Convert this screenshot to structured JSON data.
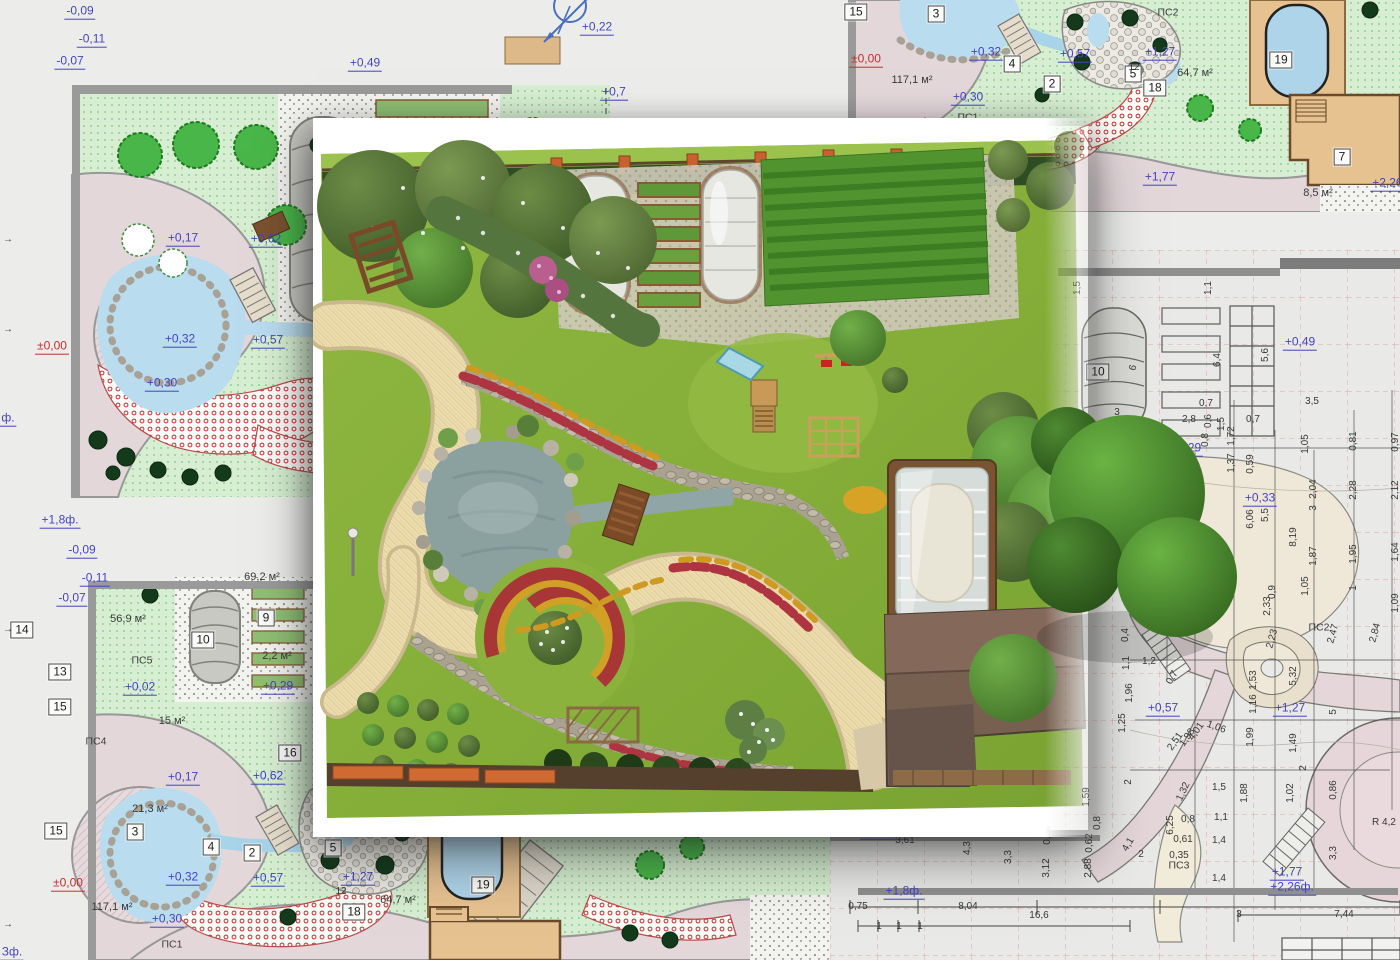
{
  "title": "Landscape design plan with 3D garden visualization",
  "colors": {
    "page_bg": "#ecedeb",
    "blueprint_lawn": "#d8eed3",
    "blueprint_path": "#e3d7da",
    "water": "#b9dcee",
    "annotation_blue": "#4443c6",
    "annotation_red": "#c32f2f",
    "tech_grid_red": "#dca9a9",
    "render_lawn": "#86ae39",
    "render_path": "#ecdcae",
    "roof_brown": "#77604f",
    "fence_orange": "#c9602f"
  },
  "compass": {
    "icon": "north-arrow"
  },
  "page_marks": [
    {
      "t": "→",
      "x": 8,
      "y": 240,
      "k": "dim"
    },
    {
      "t": "→",
      "x": 8,
      "y": 330,
      "k": "dim"
    },
    {
      "t": "→",
      "x": 8,
      "y": 630,
      "k": "dim"
    },
    {
      "t": "→",
      "x": 8,
      "y": 925,
      "k": "dim"
    }
  ],
  "top_left_plan": {
    "labels": [
      {
        "t": "-0,09",
        "x": 80,
        "y": 12,
        "k": "el"
      },
      {
        "t": "-0,11",
        "x": 92,
        "y": 40,
        "k": "el"
      },
      {
        "t": "-0,07",
        "x": 70,
        "y": 62,
        "k": "el"
      },
      {
        "t": "+0,49",
        "x": 365,
        "y": 64,
        "k": "el"
      },
      {
        "t": "+0,22",
        "x": 597,
        "y": 28,
        "k": "el"
      },
      {
        "t": "+0,7",
        "x": 614,
        "y": 93,
        "k": "el"
      },
      {
        "t": "+0,17",
        "x": 183,
        "y": 239,
        "k": "el"
      },
      {
        "t": "+0,62",
        "x": 266,
        "y": 240,
        "k": "el"
      },
      {
        "t": "+0,32",
        "x": 180,
        "y": 340,
        "k": "el"
      },
      {
        "t": "+0,57",
        "x": 268,
        "y": 341,
        "k": "el"
      },
      {
        "t": "±0,00",
        "x": 52,
        "y": 347,
        "k": "red"
      },
      {
        "t": "+0,30",
        "x": 162,
        "y": 384,
        "k": "el"
      },
      {
        "t": "+1,8ф.",
        "x": 60,
        "y": 521,
        "k": "el"
      },
      {
        "t": "ф.",
        "x": 8,
        "y": 419,
        "k": "el"
      }
    ]
  },
  "bottom_left_plan": {
    "labels": [
      {
        "t": "-0,09",
        "x": 82,
        "y": 551,
        "k": "el"
      },
      {
        "t": "-0,11",
        "x": 95,
        "y": 579,
        "k": "el"
      },
      {
        "t": "-0,07",
        "x": 72,
        "y": 599,
        "k": "el"
      },
      {
        "t": "56,9 м²",
        "x": 128,
        "y": 620,
        "k": "area"
      },
      {
        "t": "69,2 м²",
        "x": 262,
        "y": 578,
        "k": "area"
      },
      {
        "t": "9",
        "x": 266,
        "y": 618,
        "k": "box"
      },
      {
        "t": "10",
        "x": 203,
        "y": 640,
        "k": "box"
      },
      {
        "t": "2,2 м²",
        "x": 277,
        "y": 657,
        "k": "area"
      },
      {
        "t": "+0,29",
        "x": 278,
        "y": 687,
        "k": "el"
      },
      {
        "t": "ПС5",
        "x": 142,
        "y": 661,
        "k": "code"
      },
      {
        "t": "+0,02",
        "x": 140,
        "y": 688,
        "k": "el"
      },
      {
        "t": "14",
        "x": 22,
        "y": 630,
        "k": "box"
      },
      {
        "t": "13",
        "x": 60,
        "y": 672,
        "k": "box"
      },
      {
        "t": "15",
        "x": 60,
        "y": 707,
        "k": "box"
      },
      {
        "t": "ПС4",
        "x": 96,
        "y": 742,
        "k": "code"
      },
      {
        "t": "15 м²",
        "x": 172,
        "y": 722,
        "k": "area"
      },
      {
        "t": "16",
        "x": 290,
        "y": 753,
        "k": "box"
      },
      {
        "t": "+0,17",
        "x": 183,
        "y": 778,
        "k": "el"
      },
      {
        "t": "+0,62",
        "x": 268,
        "y": 777,
        "k": "el"
      },
      {
        "t": "21,3 м²",
        "x": 150,
        "y": 810,
        "k": "area"
      },
      {
        "t": "3",
        "x": 135,
        "y": 832,
        "k": "box"
      },
      {
        "t": "15",
        "x": 56,
        "y": 831,
        "k": "box"
      },
      {
        "t": "4",
        "x": 211,
        "y": 847,
        "k": "box"
      },
      {
        "t": "2",
        "x": 252,
        "y": 853,
        "k": "box"
      },
      {
        "t": "5",
        "x": 333,
        "y": 848,
        "k": "box"
      },
      {
        "t": "±0,00",
        "x": 68,
        "y": 884,
        "k": "red"
      },
      {
        "t": "+0,32",
        "x": 183,
        "y": 878,
        "k": "el"
      },
      {
        "t": "+0,57",
        "x": 268,
        "y": 879,
        "k": "el"
      },
      {
        "t": "+1,27",
        "x": 358,
        "y": 878,
        "k": "el"
      },
      {
        "t": "12",
        "x": 341,
        "y": 892,
        "k": "dim"
      },
      {
        "t": "18",
        "x": 354,
        "y": 912,
        "k": "box"
      },
      {
        "t": "64,7 м²",
        "x": 398,
        "y": 901,
        "k": "area"
      },
      {
        "t": "117,1 м²",
        "x": 112,
        "y": 908,
        "k": "area"
      },
      {
        "t": "+0,30",
        "x": 167,
        "y": 920,
        "k": "el"
      },
      {
        "t": "ПС1",
        "x": 172,
        "y": 945,
        "k": "code"
      },
      {
        "t": "19",
        "x": 483,
        "y": 885,
        "k": "box"
      },
      {
        "t": "Зф.",
        "x": 12,
        "y": 953,
        "k": "el"
      }
    ]
  },
  "top_right_plan": {
    "labels": [
      {
        "t": "15",
        "x": 856,
        "y": 12,
        "k": "box"
      },
      {
        "t": "3",
        "x": 936,
        "y": 14,
        "k": "box"
      },
      {
        "t": "4",
        "x": 1012,
        "y": 64,
        "k": "box"
      },
      {
        "t": "2",
        "x": 1052,
        "y": 84,
        "k": "box"
      },
      {
        "t": "5",
        "x": 1133,
        "y": 74,
        "k": "box"
      },
      {
        "t": "ПС2",
        "x": 1168,
        "y": 13,
        "k": "code"
      },
      {
        "t": "±0,00",
        "x": 866,
        "y": 60,
        "k": "red"
      },
      {
        "t": "+0,32",
        "x": 986,
        "y": 53,
        "k": "el"
      },
      {
        "t": "+0,57",
        "x": 1075,
        "y": 55,
        "k": "el"
      },
      {
        "t": "117,1 м²",
        "x": 912,
        "y": 81,
        "k": "area"
      },
      {
        "t": "+0,30",
        "x": 968,
        "y": 98,
        "k": "el"
      },
      {
        "t": "ПС1",
        "x": 968,
        "y": 118,
        "k": "code"
      },
      {
        "t": "+1,27",
        "x": 1160,
        "y": 53,
        "k": "el"
      },
      {
        "t": "12",
        "x": 1134,
        "y": 68,
        "k": "dim"
      },
      {
        "t": "18",
        "x": 1155,
        "y": 88,
        "k": "box"
      },
      {
        "t": "64,7 м²",
        "x": 1195,
        "y": 74,
        "k": "area"
      },
      {
        "t": "19",
        "x": 1281,
        "y": 60,
        "k": "box"
      },
      {
        "t": "7",
        "x": 1342,
        "y": 157,
        "k": "box"
      },
      {
        "t": "+1,77",
        "x": 1160,
        "y": 178,
        "k": "el"
      },
      {
        "t": "+2,26ф.",
        "x": 1394,
        "y": 184,
        "k": "el"
      },
      {
        "t": "8,5 м²",
        "x": 1318,
        "y": 194,
        "k": "area"
      }
    ]
  },
  "tech_drawing": {
    "labels": [
      {
        "t": "1,5",
        "x": 1078,
        "y": 288,
        "r": -90
      },
      {
        "t": "1,1",
        "x": 1209,
        "y": 288,
        "r": -90
      },
      {
        "t": "10",
        "x": 1098,
        "y": 372,
        "k": "box"
      },
      {
        "t": "6",
        "x": 1134,
        "y": 368,
        "r": -75
      },
      {
        "t": "6,4",
        "x": 1218,
        "y": 360,
        "r": -90
      },
      {
        "t": "5,6",
        "x": 1266,
        "y": 355,
        "r": -90
      },
      {
        "t": "+0,49",
        "x": 1300,
        "y": 343,
        "k": "el"
      },
      {
        "t": "3,5",
        "x": 1312,
        "y": 402
      },
      {
        "t": "0,7",
        "x": 1206,
        "y": 404
      },
      {
        "t": "2,8",
        "x": 1189,
        "y": 420
      },
      {
        "t": "0,6",
        "x": 1209,
        "y": 421,
        "r": -90
      },
      {
        "t": "1,5",
        "x": 1222,
        "y": 424,
        "r": -90
      },
      {
        "t": "0,7",
        "x": 1253,
        "y": 420
      },
      {
        "t": "1,72",
        "x": 1232,
        "y": 436,
        "r": -90
      },
      {
        "t": "0,8",
        "x": 1206,
        "y": 440,
        "r": -90
      },
      {
        "t": "3",
        "x": 1117,
        "y": 413
      },
      {
        "t": "0,9",
        "x": 1133,
        "y": 428,
        "r": -60
      },
      {
        "t": "+0,29",
        "x": 1186,
        "y": 449,
        "k": "el"
      },
      {
        "t": "1,37",
        "x": 1232,
        "y": 463,
        "r": -90
      },
      {
        "t": "0,59",
        "x": 1251,
        "y": 464,
        "r": -90
      },
      {
        "t": "1,05",
        "x": 1306,
        "y": 444,
        "r": -90
      },
      {
        "t": "0,81",
        "x": 1354,
        "y": 441,
        "r": -90
      },
      {
        "t": "0,97",
        "x": 1396,
        "y": 442,
        "r": -90
      },
      {
        "t": "2,04",
        "x": 1314,
        "y": 489,
        "r": -90
      },
      {
        "t": "2,28",
        "x": 1354,
        "y": 490,
        "r": -90
      },
      {
        "t": "2,12",
        "x": 1396,
        "y": 490,
        "r": -90
      },
      {
        "t": "+0,33",
        "x": 1260,
        "y": 499,
        "k": "el"
      },
      {
        "t": "6,06",
        "x": 1251,
        "y": 519,
        "r": -90
      },
      {
        "t": "5,5",
        "x": 1266,
        "y": 515,
        "r": -90
      },
      {
        "t": "3",
        "x": 1314,
        "y": 508,
        "r": -90
      },
      {
        "t": "8,19",
        "x": 1294,
        "y": 537,
        "r": -90
      },
      {
        "t": "1,87",
        "x": 1314,
        "y": 556,
        "r": -90
      },
      {
        "t": "1,95",
        "x": 1354,
        "y": 554,
        "r": -90
      },
      {
        "t": "1,64",
        "x": 1396,
        "y": 552,
        "r": -90
      },
      {
        "t": "1,05",
        "x": 1306,
        "y": 586,
        "r": -90
      },
      {
        "t": "0,9",
        "x": 1273,
        "y": 592,
        "r": -90
      },
      {
        "t": "2,33",
        "x": 1268,
        "y": 606,
        "r": -90
      },
      {
        "t": "1",
        "x": 1354,
        "y": 588,
        "r": -90
      },
      {
        "t": "1,09",
        "x": 1396,
        "y": 603,
        "r": -90
      },
      {
        "t": "ПС2",
        "x": 1319,
        "y": 628,
        "k": "code"
      },
      {
        "t": "2,47",
        "x": 1334,
        "y": 634,
        "r": -75
      },
      {
        "t": "2,84",
        "x": 1376,
        "y": 633,
        "r": -75
      },
      {
        "t": "2,23",
        "x": 1273,
        "y": 639,
        "r": -75
      },
      {
        "t": "0,4",
        "x": 1126,
        "y": 635,
        "r": -90
      },
      {
        "t": "1,2",
        "x": 1149,
        "y": 662
      },
      {
        "t": "1,1",
        "x": 1127,
        "y": 663,
        "r": -90
      },
      {
        "t": "1,96",
        "x": 1130,
        "y": 693,
        "r": -90
      },
      {
        "t": "0,7",
        "x": 1173,
        "y": 678,
        "r": -60
      },
      {
        "t": "1,53",
        "x": 1254,
        "y": 680,
        "r": -90
      },
      {
        "t": "1,16",
        "x": 1254,
        "y": 704,
        "r": -90
      },
      {
        "t": "5,32",
        "x": 1294,
        "y": 676,
        "r": -90
      },
      {
        "t": "+1,27",
        "x": 1290,
        "y": 709,
        "k": "el"
      },
      {
        "t": "+0,57",
        "x": 1163,
        "y": 709,
        "k": "el"
      },
      {
        "t": "1,06",
        "x": 1216,
        "y": 728,
        "r": 20
      },
      {
        "t": "4,01",
        "x": 1197,
        "y": 732,
        "r": -55
      },
      {
        "t": "2,51",
        "x": 1176,
        "y": 742,
        "r": -55
      },
      {
        "t": "1,98",
        "x": 1188,
        "y": 738,
        "r": -55
      },
      {
        "t": "1,99",
        "x": 1251,
        "y": 737,
        "r": -90
      },
      {
        "t": "1,49",
        "x": 1294,
        "y": 743,
        "r": -90
      },
      {
        "t": "5",
        "x": 1334,
        "y": 712,
        "r": -90
      },
      {
        "t": "1,25",
        "x": 1123,
        "y": 723,
        "r": -90
      },
      {
        "t": "2",
        "x": 1129,
        "y": 782,
        "r": -90
      },
      {
        "t": "1,32",
        "x": 1184,
        "y": 792,
        "r": -65
      },
      {
        "t": "1,5",
        "x": 1219,
        "y": 788
      },
      {
        "t": "1,88",
        "x": 1245,
        "y": 793,
        "r": -90
      },
      {
        "t": "1,02",
        "x": 1291,
        "y": 793,
        "r": -90
      },
      {
        "t": "0,86",
        "x": 1334,
        "y": 790,
        "r": -90
      },
      {
        "t": "2",
        "x": 1304,
        "y": 768,
        "r": -90
      },
      {
        "t": "6,25",
        "x": 1171,
        "y": 825,
        "r": -90
      },
      {
        "t": "0,8",
        "x": 1188,
        "y": 820
      },
      {
        "t": "1,1",
        "x": 1221,
        "y": 818
      },
      {
        "t": "R 4,2",
        "x": 1384,
        "y": 823
      },
      {
        "t": "0,61",
        "x": 1183,
        "y": 840
      },
      {
        "t": "1,4",
        "x": 1219,
        "y": 841
      },
      {
        "t": "0,35",
        "x": 1179,
        "y": 856
      },
      {
        "t": "ПС3",
        "x": 1179,
        "y": 866,
        "k": "code"
      },
      {
        "t": "1,4",
        "x": 1219,
        "y": 879
      },
      {
        "t": "+1,77",
        "x": 1287,
        "y": 873,
        "k": "el"
      },
      {
        "t": "+2,26ф.",
        "x": 1292,
        "y": 888,
        "k": "el"
      },
      {
        "t": "3",
        "x": 1239,
        "y": 915
      },
      {
        "t": "7,44",
        "x": 1344,
        "y": 915
      },
      {
        "t": "3,3",
        "x": 1334,
        "y": 853,
        "r": -90
      },
      {
        "t": "+0,7",
        "x": 895,
        "y": 822,
        "k": "el"
      },
      {
        "t": "+1,03ф.",
        "x": 884,
        "y": 832,
        "k": "el"
      },
      {
        "t": "0,3",
        "x": 930,
        "y": 827,
        "r": -90
      },
      {
        "t": "3,61",
        "x": 905,
        "y": 841
      },
      {
        "t": "4,3",
        "x": 968,
        "y": 848,
        "r": -90
      },
      {
        "t": "3,3",
        "x": 1009,
        "y": 857,
        "r": -90
      },
      {
        "t": "0,58",
        "x": 1048,
        "y": 835,
        "r": -90
      },
      {
        "t": "3,12",
        "x": 1047,
        "y": 868,
        "r": -90
      },
      {
        "t": "2,88",
        "x": 1089,
        "y": 868,
        "r": -90
      },
      {
        "t": "0,62",
        "x": 1090,
        "y": 843,
        "r": -90
      },
      {
        "t": "1,59",
        "x": 1087,
        "y": 797,
        "r": -90
      },
      {
        "t": "0,8",
        "x": 1098,
        "y": 823,
        "r": -90
      },
      {
        "t": "+1,8ф.",
        "x": 904,
        "y": 892,
        "k": "el"
      },
      {
        "t": "0,75",
        "x": 858,
        "y": 907
      },
      {
        "t": "8,04",
        "x": 968,
        "y": 907
      },
      {
        "t": "16,6",
        "x": 1039,
        "y": 916
      },
      {
        "t": "1",
        "x": 879,
        "y": 927
      },
      {
        "t": "1",
        "x": 899,
        "y": 927
      },
      {
        "t": "1",
        "x": 920,
        "y": 927
      },
      {
        "t": "4,1",
        "x": 1129,
        "y": 845,
        "r": -60
      },
      {
        "t": "2",
        "x": 1141,
        "y": 855
      }
    ]
  }
}
